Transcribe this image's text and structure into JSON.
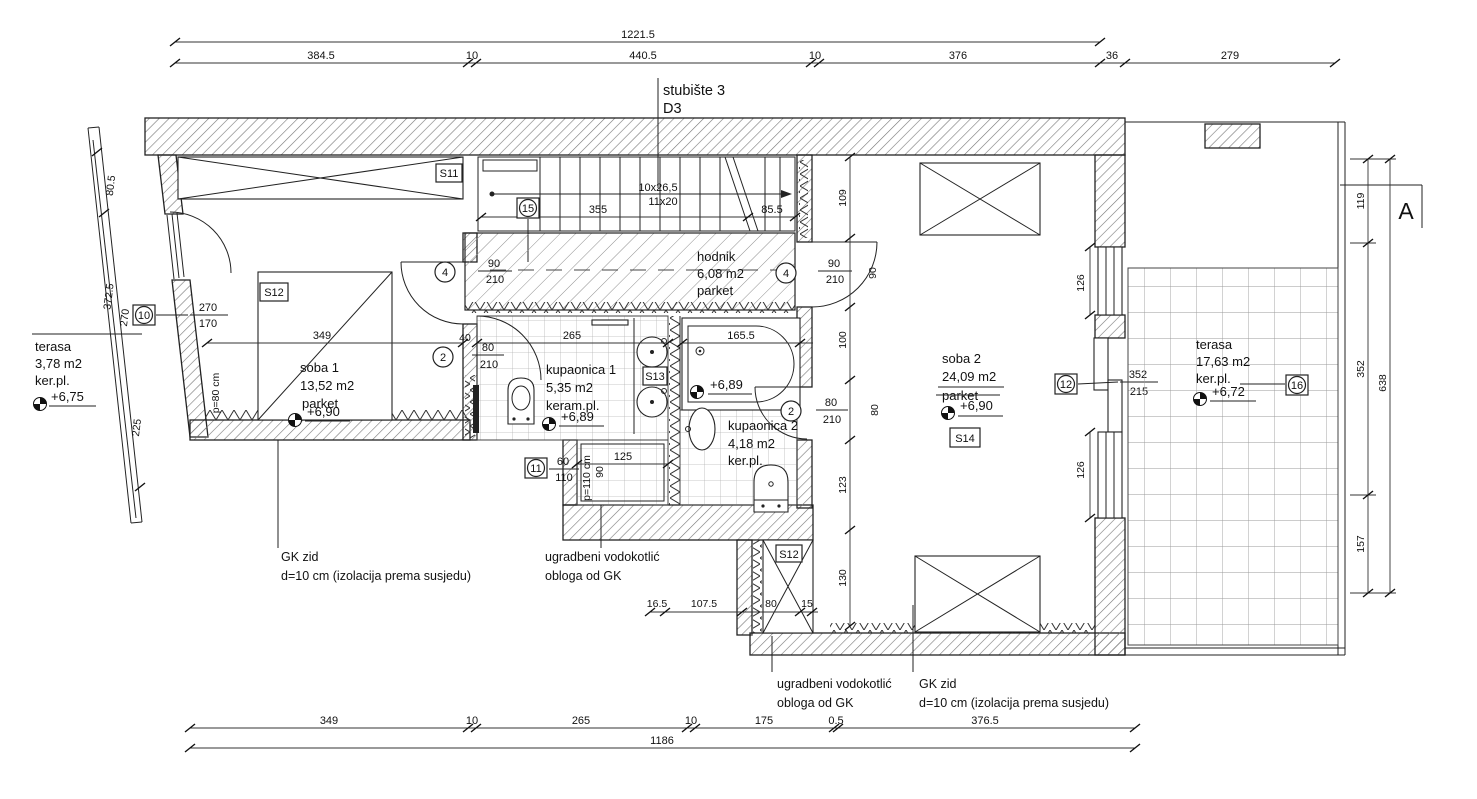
{
  "colors": {
    "ink": "#111111",
    "hatch": "#777777",
    "grid": "#b6b6b6"
  },
  "stair": {
    "title": "stubište 3",
    "door": "D3",
    "steps1": "10x26,5",
    "steps2": "11x20"
  },
  "section": {
    "label": "A"
  },
  "rooms": {
    "hodnik": {
      "name": "hodnik",
      "area": "6,08 m2",
      "floor": "parket"
    },
    "soba1": {
      "name": "soba 1",
      "area": "13,52 m2",
      "floor": "parket",
      "level": "+6,90"
    },
    "kupaonica1": {
      "name": "kupaonica 1",
      "area": "5,35 m2",
      "floor": "keram.pl.",
      "level": "+6,89"
    },
    "kupaonica2": {
      "name": "kupaonica 2",
      "area": "4,18 m2",
      "floor": "ker.pl.",
      "level": "+6,89"
    },
    "soba2": {
      "name": "soba 2",
      "area": "24,09 m2",
      "floor": "parket",
      "level": "+6,90"
    },
    "terasa_left": {
      "name": "terasa",
      "area": "3,78 m2",
      "floor": "ker.pl.",
      "level": "+6,75"
    },
    "terasa_right": {
      "name": "terasa",
      "area": "17,63 m2",
      "floor": "ker.pl.",
      "level": "+6,72"
    }
  },
  "room_marks": {
    "s11": "S11",
    "s12_soba1": "S12",
    "s12_closet": "S12",
    "s13": "S13",
    "s14": "S14"
  },
  "openings": {
    "m10": {
      "no": "10",
      "w": "270",
      "h": "170",
      "parapet": "p=80 cm"
    },
    "m11": {
      "no": "11",
      "w": "60",
      "h": "110",
      "parapet": "p=110 cm",
      "extra": "90"
    },
    "m12": {
      "no": "12",
      "w": "352",
      "h": "215"
    },
    "m15": {
      "no": "15"
    },
    "m16": {
      "no": "16"
    },
    "d4_left": {
      "no": "4",
      "w": "90",
      "h": "210"
    },
    "d4_right": {
      "no": "4",
      "w": "90",
      "h": "210"
    },
    "d2_left": {
      "no": "2",
      "w": "80",
      "h": "210",
      "extra": "40"
    },
    "d2_right": {
      "no": "2",
      "w": "80",
      "h": "210"
    }
  },
  "notes": {
    "gk_left": [
      "GK zid",
      "d=10 cm (izolacija prema susjedu)"
    ],
    "gk_right": [
      "GK zid",
      "d=10 cm (izolacija prema susjedu)"
    ],
    "cistern_left": [
      "ugradbeni vodokotlić",
      "obloga od GK"
    ],
    "cistern_right": [
      "ugradbeni vodokotlić",
      "obloga od GK"
    ]
  },
  "dims": {
    "top_total": "1221.5",
    "top": [
      "384.5",
      "10",
      "440.5",
      "10",
      "376",
      "36",
      "279"
    ],
    "bottom": [
      "349",
      "10",
      "265",
      "10",
      "175",
      "0.5",
      "376.5"
    ],
    "bottom_total": "1186",
    "stairs": [
      "355",
      "85.5"
    ],
    "soba1_width": "349",
    "kup1_width": "265",
    "tub": "165.5",
    "shower": "125",
    "mid_chain": [
      "109",
      "90",
      "100",
      "80",
      "123",
      "130"
    ],
    "closet_row": [
      "16.5",
      "107.5",
      "80",
      "15"
    ],
    "right_wall": [
      "126",
      "126"
    ],
    "right_chain": [
      "119",
      "352",
      "157"
    ],
    "right_total": "638",
    "left_chain": [
      "80.5",
      "372.5",
      "270",
      "225"
    ]
  }
}
